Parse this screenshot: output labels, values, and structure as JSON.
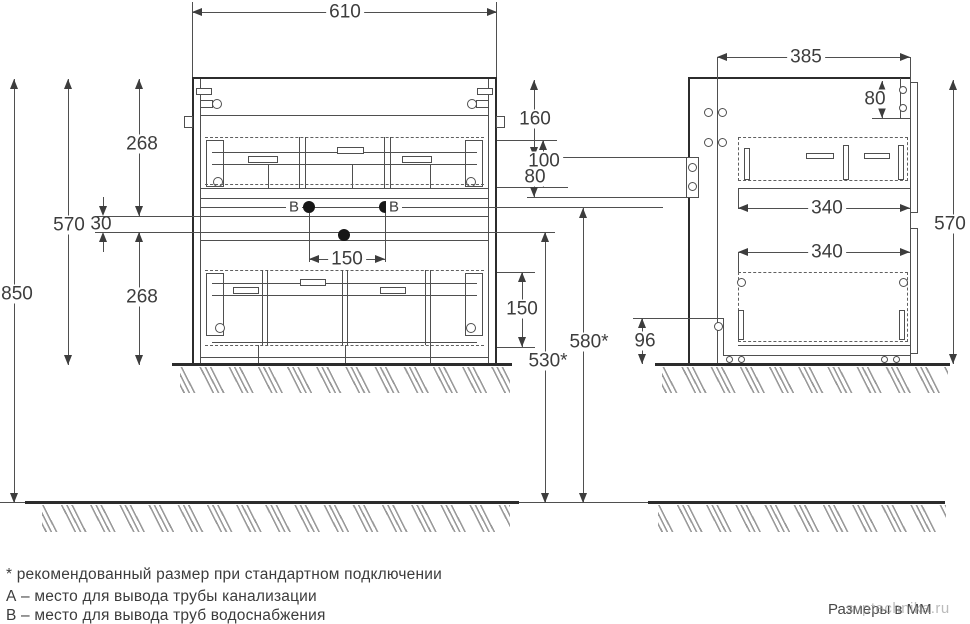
{
  "front_view": {
    "width": "610",
    "overall_height": "850",
    "cabinet_height": "570",
    "upper_section": "268",
    "center_gap": "30",
    "lower_section": "268",
    "supply_spacing": "150",
    "upper_drawer_inner": "100",
    "lower_drawer_inner": "150",
    "water_supply_height": "580*",
    "drain_height": "530*",
    "point_b_label": "В"
  },
  "side_view": {
    "depth": "385",
    "cabinet_height": "570",
    "top_to_bracket": "160",
    "bracket_height": "80",
    "top_rail_depth": "80",
    "upper_drawer_depth": "340",
    "lower_drawer_depth": "340",
    "base_height": "96"
  },
  "legend": {
    "asterisk_note": "* рекомендованный размер при стандартном подключении",
    "point_a_note": "А – место для вывода трубы канализации",
    "point_b_note": "В – место для вывода труб водоснабжения"
  },
  "footer": {
    "units_note": "Размеры в ММ"
  },
  "watermark": "svptechnika.ru"
}
